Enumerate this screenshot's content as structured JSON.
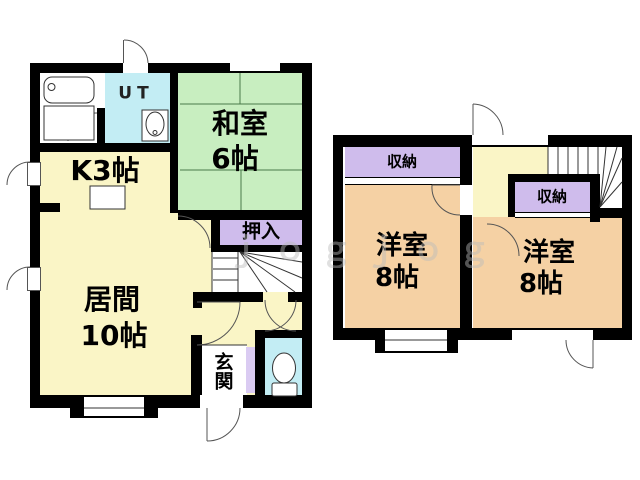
{
  "title": "間取り図",
  "colors": {
    "wall": "#000000",
    "yellow": "#FAF5C6",
    "green": "#C8EEC0",
    "cyan": "#C3EDF4",
    "purple": "#CFBCEC",
    "purplel": "#DACBF2",
    "peach": "#F5D1A4",
    "line": "#333333",
    "watermark": "#BBBBBB"
  },
  "floor1": {
    "ut_label": "UT",
    "washitsu_name": "和室",
    "washitsu_size": "6帖",
    "kitchen_label": "K3帖",
    "oshiire_label": "押入",
    "living_name": "居間",
    "living_size": "10帖",
    "genkan_label": "玄関"
  },
  "floor2": {
    "storage_left_label": "収納",
    "storage_right_label": "収納",
    "yoshitsu_left_name": "洋室",
    "yoshitsu_left_size": "8帖",
    "yoshitsu_right_name": "洋室",
    "yoshitsu_right_size": "8帖"
  },
  "watermark_text": "ｊｏｇｊｏｇ"
}
